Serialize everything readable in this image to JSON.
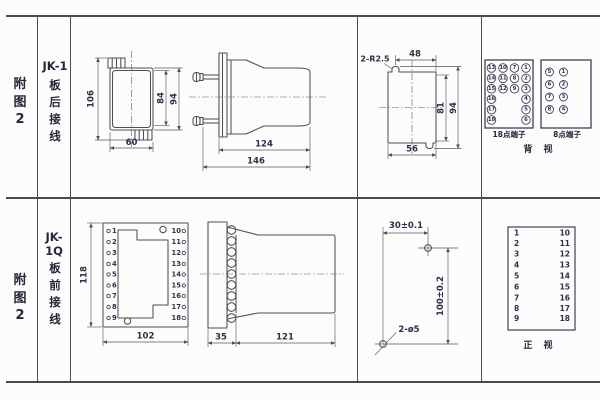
{
  "colors": {
    "bg": "#fcfcfc",
    "grid": "#4b4b4b",
    "line": "#4f4f4f",
    "text": "#2c3148"
  },
  "row1": {
    "figure_label": "附\n图\n2",
    "model": "JK-1",
    "wiring": "板\n后\n接\n线",
    "rear_case_dims": {
      "overall_height": "106",
      "inner_height": "84",
      "outer_height": "94",
      "width": "60"
    },
    "side_dims": {
      "body_depth": "124",
      "overall_depth": "146"
    },
    "cutout_dims": {
      "notch_radius": "2-R2.5",
      "notch_to_edge": "48",
      "opening_height": "81",
      "overall_height": "94",
      "opening_width": "56"
    },
    "back_terminals": {
      "t18_caption": "18点端子",
      "t8_caption": "8点端子",
      "view_caption": "背 视",
      "t18_col1": [
        "13",
        "14",
        "15",
        "16",
        "17",
        "18"
      ],
      "t18_col2": [
        "10",
        "11",
        "12"
      ],
      "t18_col3": [
        "7",
        "8",
        "9"
      ],
      "t18_col4": [
        "1",
        "2",
        "3",
        "4",
        "5",
        "6"
      ],
      "t8_left": [
        "5",
        "6",
        "7",
        "8"
      ],
      "t8_right": [
        "1",
        "2",
        "3",
        "4"
      ]
    }
  },
  "row2": {
    "figure_label": "附\n图\n2",
    "model": "JK-1Q",
    "wiring": "板\n前\n接\n线",
    "front_view": {
      "left_terminals": [
        "1",
        "2",
        "3",
        "4",
        "5",
        "6",
        "7",
        "8",
        "9"
      ],
      "right_terminals": [
        "10",
        "11",
        "12",
        "13",
        "14",
        "15",
        "16",
        "17",
        "18"
      ],
      "height": "118",
      "width": "102"
    },
    "side_dims": {
      "terminal_depth": "35",
      "body_depth": "121"
    },
    "drill_dims": {
      "h_spacing": "30±0.1",
      "v_spacing": "100±0.2",
      "hole_callout": "2-ø5"
    },
    "front_list": {
      "left": [
        "1",
        "2",
        "3",
        "4",
        "5",
        "6",
        "7",
        "8",
        "9"
      ],
      "right": [
        "10",
        "11",
        "12",
        "13",
        "14",
        "15",
        "16",
        "17",
        "18"
      ],
      "view_caption": "正 视"
    }
  }
}
